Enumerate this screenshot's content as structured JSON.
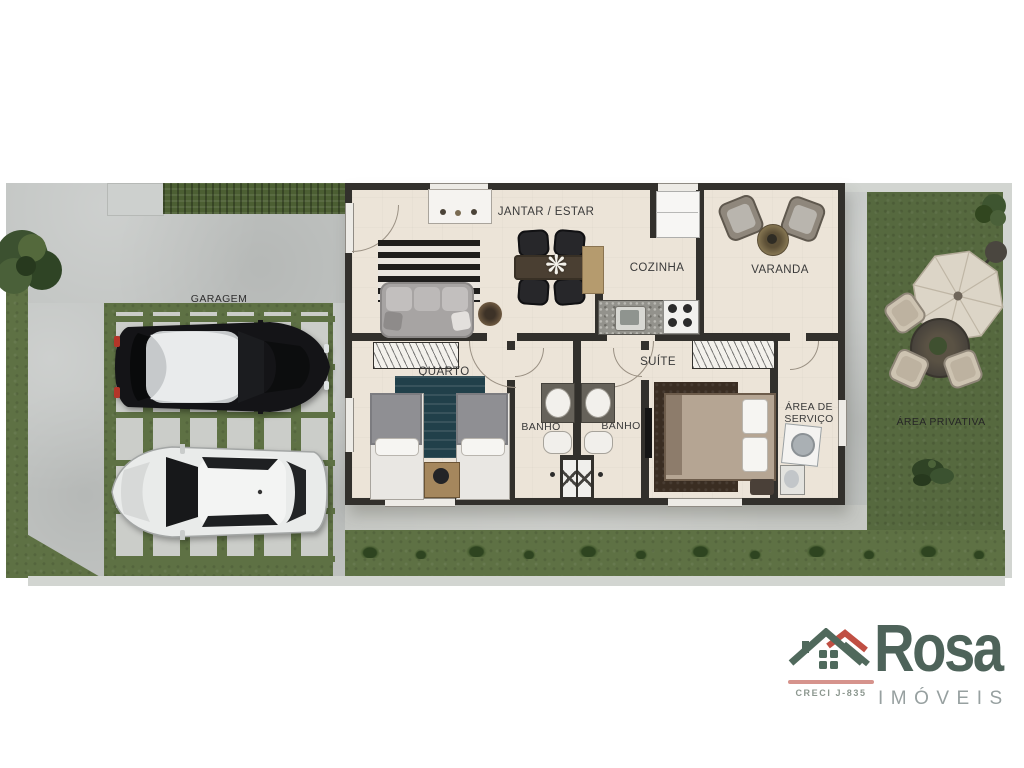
{
  "rooms": {
    "jantar_estar": "JANTAR / ESTAR",
    "cozinha": "COZINHA",
    "varanda": "VARANDA",
    "garagem": "GARAGEM",
    "quarto": "QUARTO",
    "banho_1": "BANHO",
    "banho_2": "BANHO",
    "suite": "SUÍTE",
    "area_servico_line1": "ÁREA DE",
    "area_servico_line2": "SERVIÇO",
    "area_privativa": "ÁREA PRIVATIVA"
  },
  "decor": {
    "centerpiece_glyph": "❋"
  },
  "logo": {
    "brand": "Rosa",
    "subtitle": "IMÓVEIS",
    "license": "CRECI J-835",
    "brand_color": "#4e635a",
    "subtitle_color": "#97a0a0",
    "roof_accent": "#c04f43",
    "underline_color": "#d6938c"
  },
  "palette": {
    "grass": "#5e7144",
    "street": "#c1c4c2",
    "floor": "#ece4d8",
    "wall": "#32302c",
    "sidewalk": "#c6c8c4",
    "rug_teal": "#21404a",
    "rug_brown": "#3a2d22",
    "label": "#3a3a3a"
  }
}
